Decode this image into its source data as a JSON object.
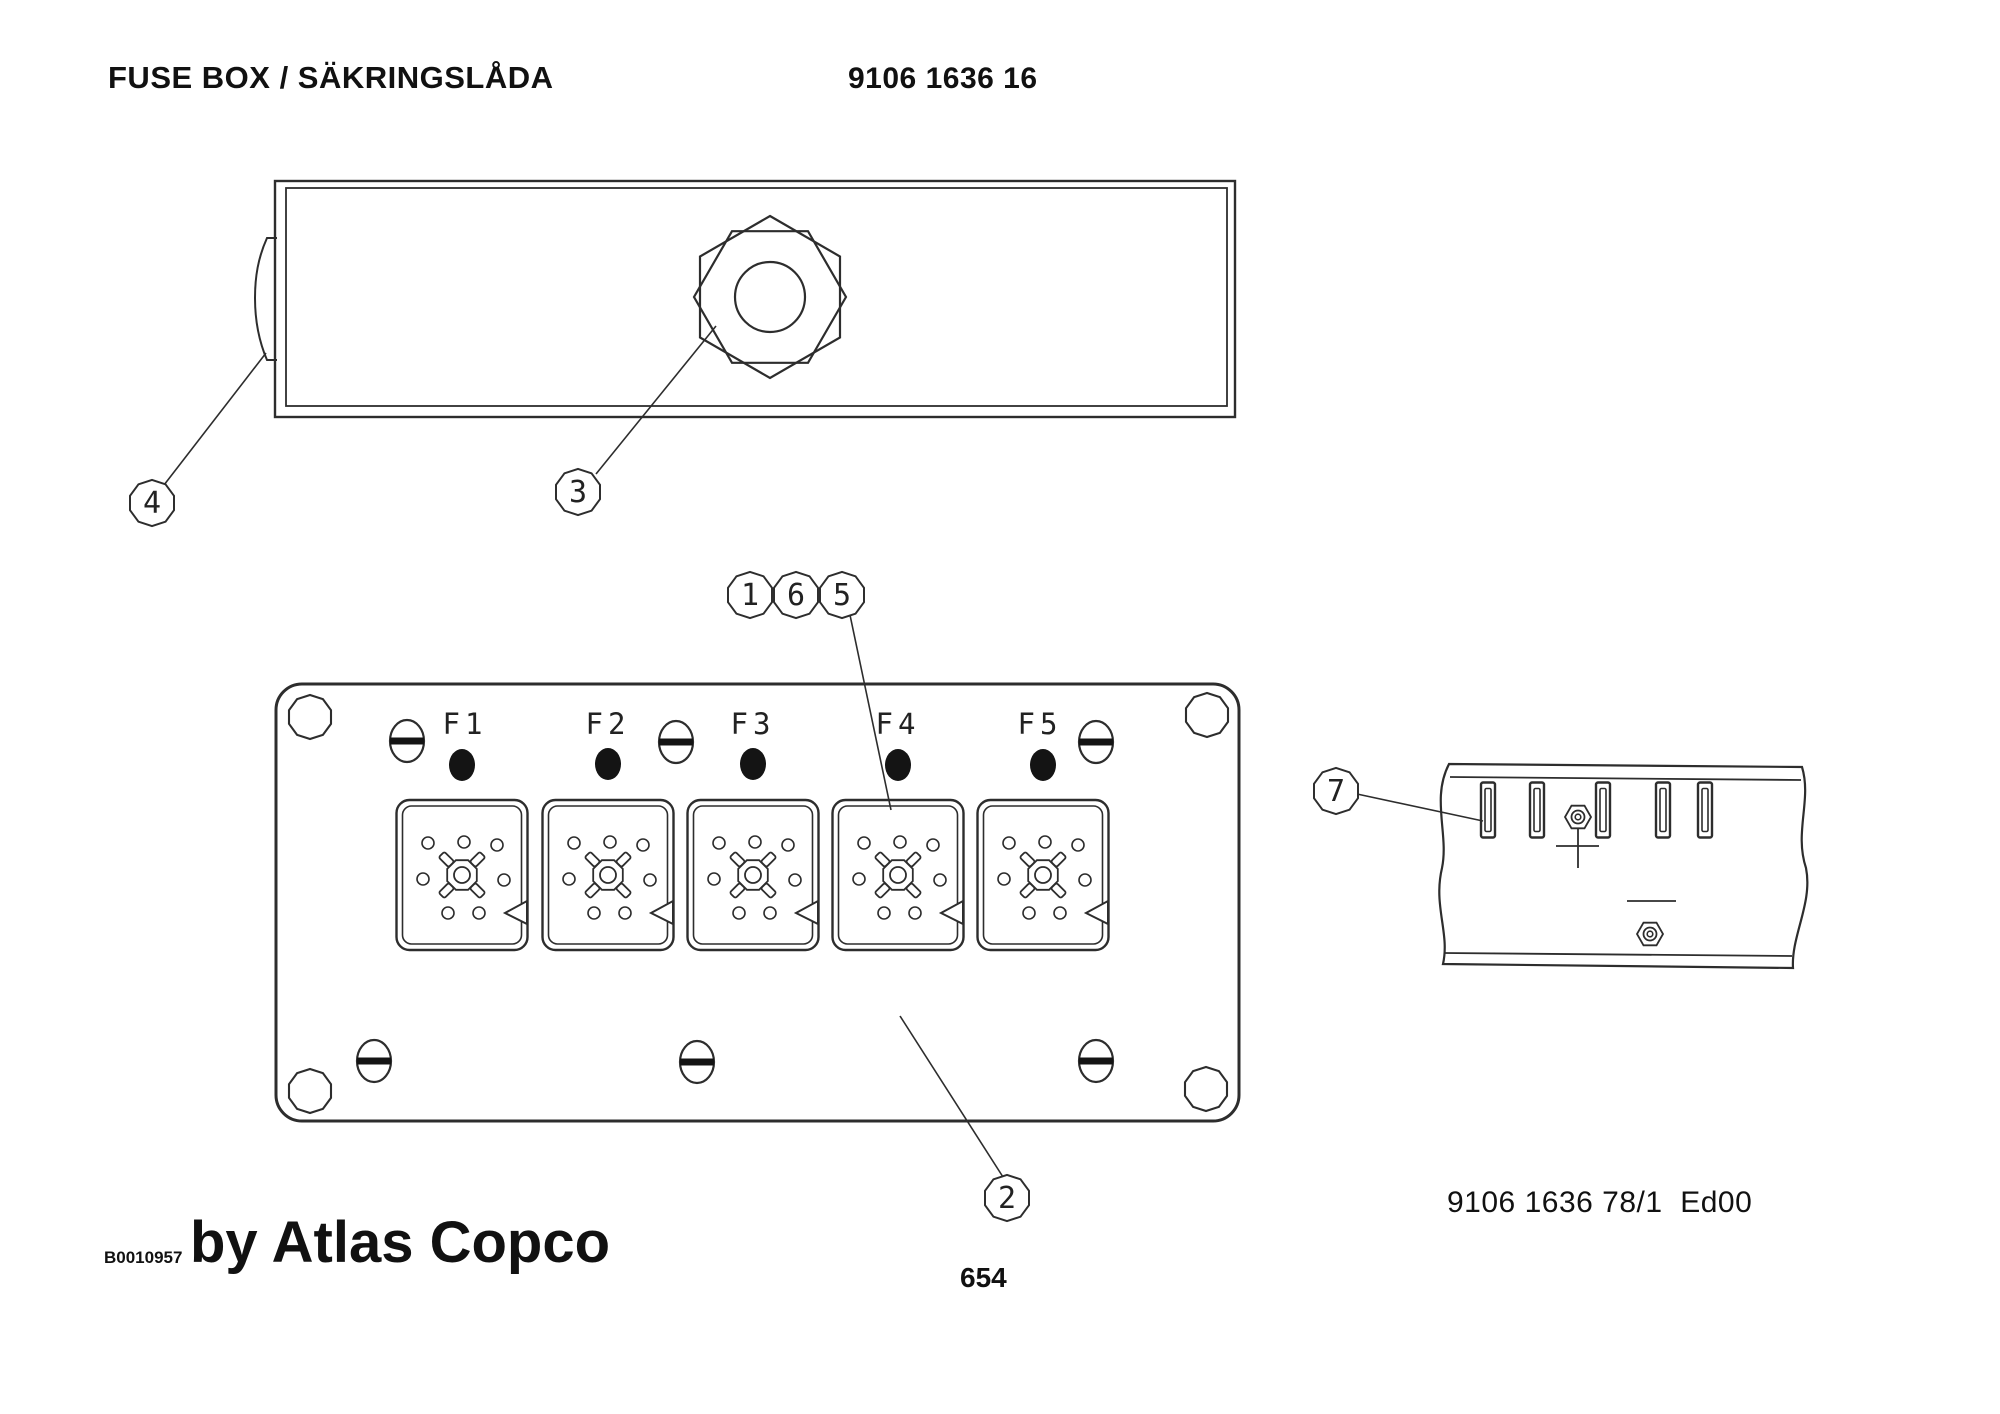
{
  "header": {
    "title": "FUSE BOX / SÄKRINGSLÅDA",
    "part_number": "9106 1636 16"
  },
  "panel": {
    "fuse_labels": [
      "F1",
      "F2",
      "F3",
      "F4",
      "F5"
    ]
  },
  "callouts": {
    "c1": "1",
    "c2": "2",
    "c3": "3",
    "c4": "4",
    "c5": "5",
    "c6": "6",
    "c7": "7"
  },
  "footer": {
    "image_code": "B0010957",
    "brand": "by Atlas Copco",
    "page_number": "654",
    "drawing_ref": "9106 1636 78/1  Ed00"
  }
}
